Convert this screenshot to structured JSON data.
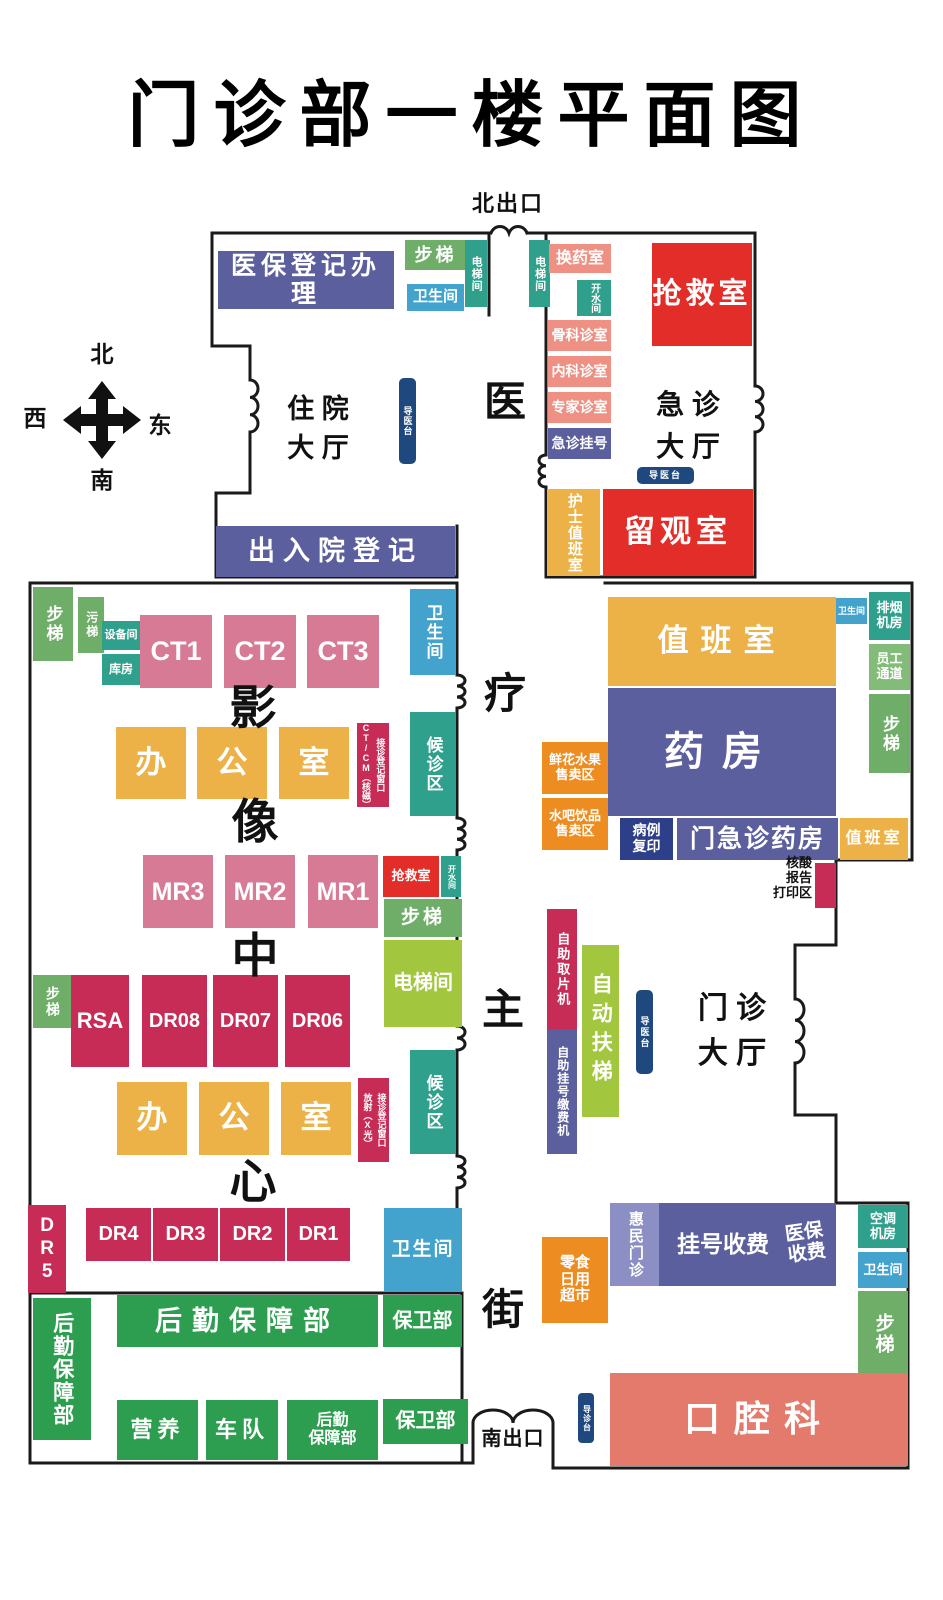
{
  "title": "门诊部一楼平面图",
  "exits": {
    "north": "北出口",
    "south": "南出口"
  },
  "compass": {
    "n": "北",
    "s": "南",
    "e": "东",
    "w": "西"
  },
  "halls": {
    "zhuyuan": "住 院\n大 厅",
    "jizhen": "急 诊\n大 厅",
    "menzhen": "门 诊\n大 厅",
    "hesuan": "核酸\n报告\n打印区",
    "corridor": [
      "医",
      "疗",
      "主",
      "街"
    ],
    "imaging": [
      "影",
      "像",
      "中",
      "心"
    ]
  },
  "rooms": {
    "yibao_dengji": "医保登记办理",
    "buti": "步梯",
    "wuti": "污梯",
    "weishengjian": "卫生间",
    "dianti_jian": "电梯间",
    "huanyao_shi": "换药室",
    "kaishui_jian": "开水间",
    "guke_zhenshi": "骨科诊室",
    "neike_zhenshi": "内科诊室",
    "zhuanjia_zhenshi": "专家诊室",
    "jizhen_guahao": "急诊挂号",
    "qiangjiu_shi": "抢救室",
    "daoyi_tai": "导医台",
    "daozhen_tai": "导诊台",
    "hushi_zhibanshi": "护士值班室",
    "liuguan_shi": "留观室",
    "churuyuan_dengji": "出入院登记",
    "shebei_jian": "设备间",
    "kufang": "库房",
    "ct1": "CT1",
    "ct2": "CT2",
    "ct3": "CT3",
    "ban": "办",
    "gong": "公",
    "shi": "室",
    "ctcm_window": "接诊登记窗口\nCT/CM（核磁）",
    "fangshe_window": "接诊登记窗口\n放射（X光）",
    "houzhen_qu": "候诊区",
    "mr1": "MR1",
    "mr2": "MR2",
    "mr3": "MR3",
    "rsa": "RSA",
    "dr08": "DR08",
    "dr07": "DR07",
    "dr06": "DR06",
    "dr5": "DR5",
    "dr4": "DR4",
    "dr3": "DR3",
    "dr2": "DR2",
    "dr1": "DR1",
    "houqin_baozhang_bu": "后勤保障部",
    "houqin_baozhang_bu_2line": "后勤\n保障部",
    "baowei_bu": "保卫部",
    "yingyang": "营养",
    "chedui": "车队",
    "paiyan_jifang": "排烟\n机房",
    "yuangong_tongdao": "员工\n通道",
    "zhiban_shi": "值班室",
    "yaofang": "药房",
    "xianhua_shuiguo": "鲜花水果\n售卖区",
    "shuiba_yinpin": "水吧饮品\n售卖区",
    "bingli_fuyin": "病例\n复印",
    "menjizhen_yaofang": "门急诊药房",
    "zizhu_qupianji": "自助取片机",
    "zizhu_guahao_jiaofeiji": "自助挂号缴费机",
    "zidong_futi": "自动扶梯",
    "lingshi_chaoshi": "零食\n日用\n超市",
    "huimin_menzhen": "惠民门诊",
    "guahao_shoufei": "挂号收费",
    "yibao_shoufei": "医保\n收费",
    "kongtiao_jifang": "空调\n机房",
    "kouqiang_ke": "口腔科"
  },
  "palette": {
    "purple": "#5b5f9e",
    "purple_light": "#8b8fc4",
    "salmon": "#ee9184",
    "red": "#e22d28",
    "rose": "#d67a95",
    "crimson": "#c62c56",
    "yellow": "#ecb147",
    "orange": "#ec8c21",
    "teal": "#2fa08c",
    "blue": "#44a3cd",
    "green": "#6fae68",
    "green_light": "#83bb78",
    "green_dark": "#2d9e50",
    "lime": "#a2c73e",
    "navy": "#2e3f8a",
    "navy_tab": "#1f497e",
    "coral": "#e37a6c",
    "wall": "#1a1a1a",
    "text_dark": "#111111"
  }
}
